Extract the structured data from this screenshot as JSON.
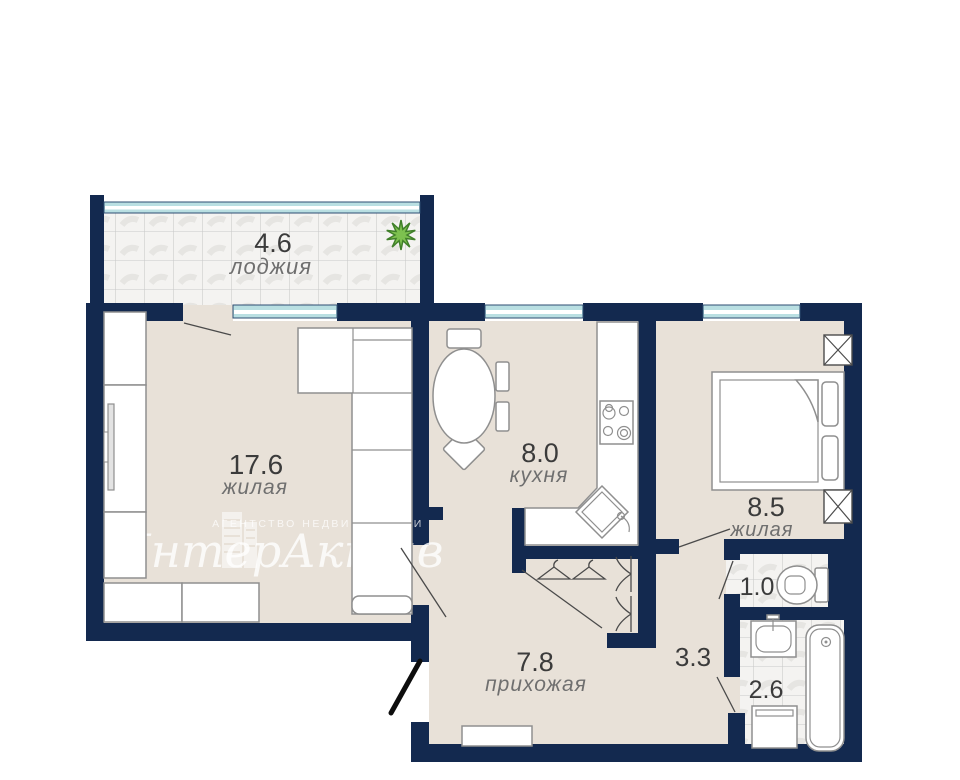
{
  "watermark": {
    "brand": "ИнтерАктив",
    "tagline": "агентство недвижимости"
  },
  "rooms": {
    "loggia": {
      "area": "4.6",
      "name": "лоджия"
    },
    "living": {
      "area": "17.6",
      "name": "жилая"
    },
    "kitchen": {
      "area": "8.0",
      "name": "кухня"
    },
    "bedroom": {
      "area": "8.5",
      "name": "жилая"
    },
    "wc": {
      "area": "1.0"
    },
    "bathroom": {
      "area": "2.6"
    },
    "hallway": {
      "area": "7.8",
      "name": "прихожая"
    },
    "corridor": {
      "area": "3.3"
    }
  },
  "colors": {
    "wall": "#13294f",
    "floor": "#e8e1d8",
    "window_glass": "#b9dfe2",
    "plant_green": "#7dc14f",
    "tile_line": "#c9c9c9",
    "label": "#3b3b3b",
    "label_secondary": "#6f6f6f"
  }
}
